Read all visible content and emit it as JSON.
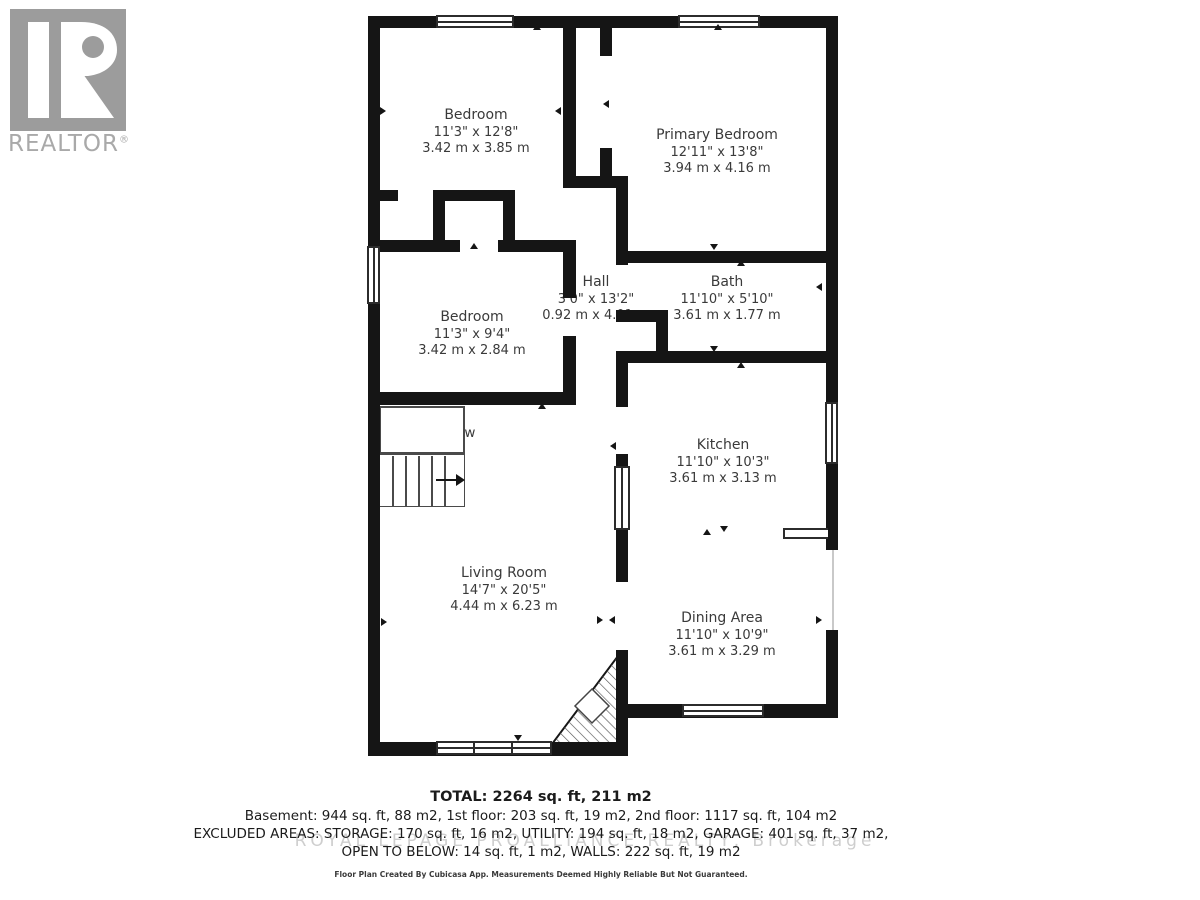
{
  "logo": {
    "brand": "REALTOR",
    "registered": "®"
  },
  "rooms": {
    "bedroom_tl": {
      "name": "Bedroom",
      "imperial": "11'3\" x 12'8\"",
      "metric": "3.42 m x 3.85 m"
    },
    "primary": {
      "name": "Primary Bedroom",
      "imperial": "12'11\" x 13'8\"",
      "metric": "3.94 m x 4.16 m"
    },
    "bedroom_l": {
      "name": "Bedroom",
      "imperial": "11'3\" x 9'4\"",
      "metric": "3.42 m x 2.84 m"
    },
    "hall": {
      "name": "Hall",
      "imperial": "3'0\" x 13'2\"",
      "metric": "0.92 m x 4.01 m"
    },
    "bath": {
      "name": "Bath",
      "imperial": "11'10\" x 5'10\"",
      "metric": "3.61 m x 1.77 m"
    },
    "kitchen": {
      "name": "Kitchen",
      "imperial": "11'10\" x 10'3\"",
      "metric": "3.61 m x 3.13 m"
    },
    "living": {
      "name": "Living Room",
      "imperial": "14'7\" x 20'5\"",
      "metric": "4.44 m x 6.23 m"
    },
    "dining": {
      "name": "Dining Area",
      "imperial": "11'10\" x 10'9\"",
      "metric": "3.61 m x 3.29 m"
    },
    "open_below": {
      "name": "Open To Below"
    }
  },
  "summary": {
    "total": "TOTAL: 2264 sq. ft, 211 m2",
    "line2": "Basement: 944 sq. ft, 88 m2, 1st floor: 203 sq. ft, 19 m2, 2nd floor: 1117 sq. ft, 104 m2",
    "line3": "EXCLUDED AREAS: STORAGE: 170 sq. ft, 16 m2, UTILITY: 194 sq. ft, 18 m2, GARAGE: 401 sq. ft, 37 m2,",
    "line4": "OPEN TO BELOW: 14 sq. ft, 1 m2, WALLS: 222 sq. ft, 19 m2"
  },
  "watermark": "ROYAL LEPAGE PROALLIANCE REALTY, Brokerage",
  "disclaimer": "Floor Plan Created By Cubicasa App. Measurements Deemed Highly Reliable But Not Guaranteed.",
  "colors": {
    "wall": "#151515",
    "label": "#3a3a3a",
    "logo_gray": "#9c9c9c",
    "watermark": "#c6c6c6"
  }
}
